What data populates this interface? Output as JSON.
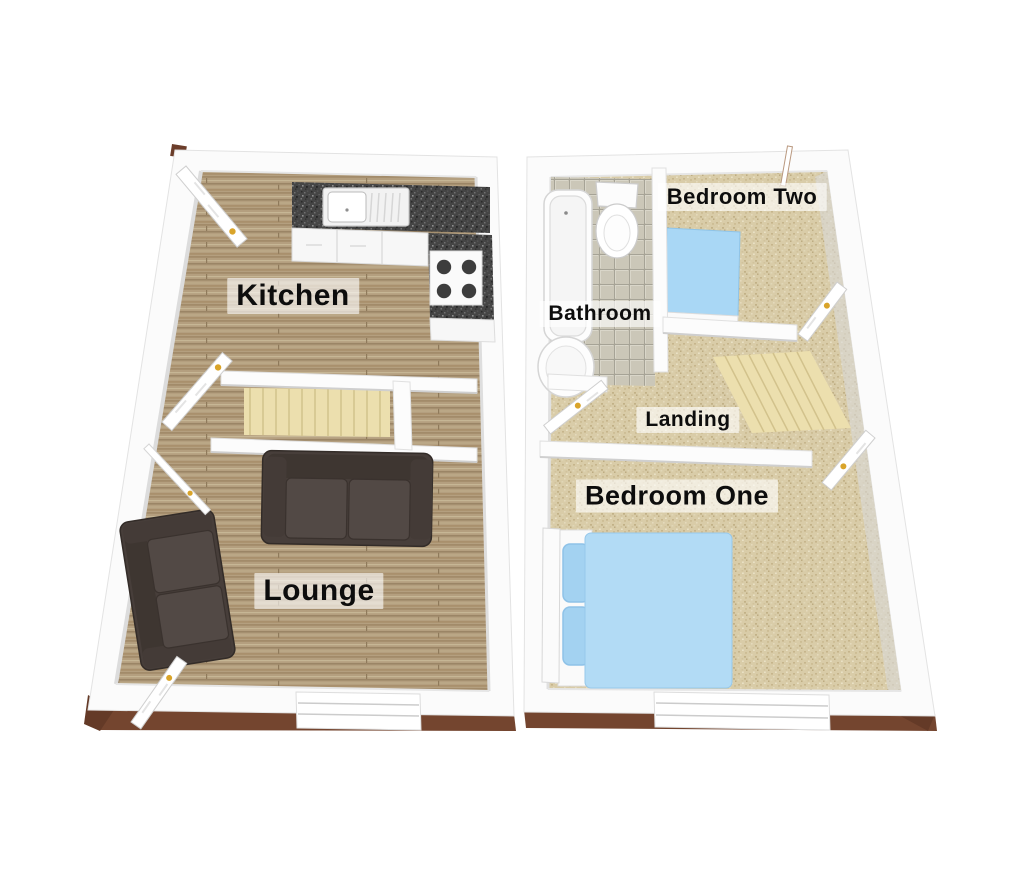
{
  "floors": [
    {
      "rooms": [
        {
          "id": "kitchen",
          "label": "Kitchen",
          "fixtures": [
            "worktop",
            "sink-drainer",
            "hob",
            "base-cabinets"
          ]
        },
        {
          "id": "lounge",
          "label": "Lounge",
          "fixtures": [
            "sofa-large",
            "sofa-small"
          ]
        }
      ],
      "features": [
        "staircase",
        "doors",
        "front-window"
      ]
    },
    {
      "rooms": [
        {
          "id": "bathroom",
          "label": "Bathroom",
          "fixtures": [
            "bathtub",
            "toilet",
            "washbasin"
          ]
        },
        {
          "id": "bedroom-two",
          "label": "Bedroom Two",
          "fixtures": [
            "single-bed"
          ]
        },
        {
          "id": "landing",
          "label": "Landing",
          "fixtures": [
            "staircase"
          ]
        },
        {
          "id": "bedroom-one",
          "label": "Bedroom One",
          "fixtures": [
            "double-bed"
          ]
        }
      ],
      "features": [
        "doors",
        "front-window"
      ]
    }
  ],
  "colors": {
    "wood_floor": "#b49f7f",
    "carpet": "#d9cca8",
    "stair_carpet": "#ecdfae",
    "bathroom_tile": "#cbc7b8",
    "worktop_granite": "#454545",
    "bed_blue": "#aad6f2",
    "sofa_brown": "#4a413d",
    "wall_white": "#fcfcfc",
    "plinth_brown": "#74452f",
    "door_handle_gold": "#d9a42a",
    "label_text": "#0d0d0d"
  }
}
